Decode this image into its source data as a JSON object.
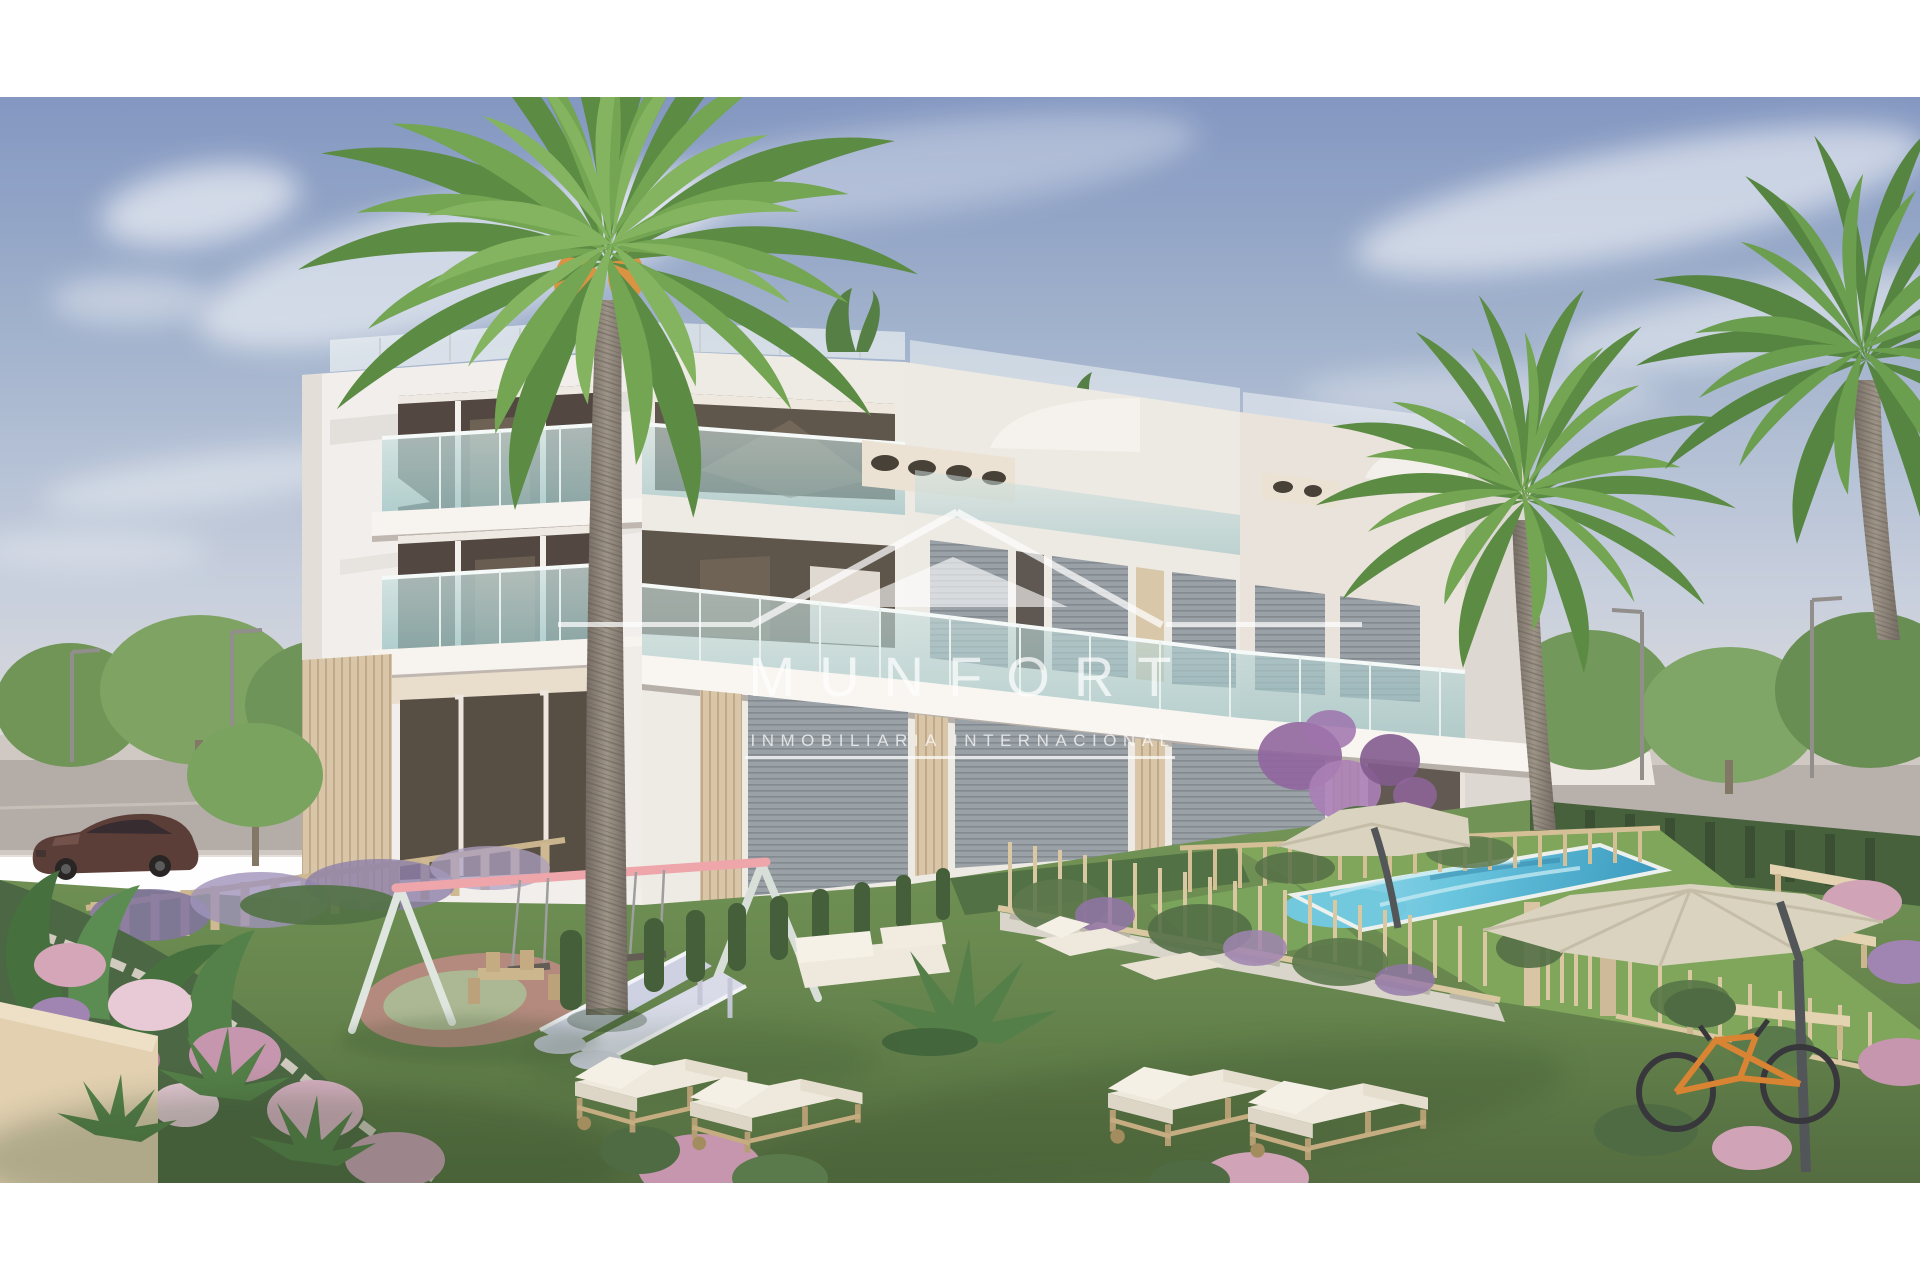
{
  "watermark": {
    "brand": "MUNFORT",
    "tagline": "INMOBILIARIA INTERNACIONAL",
    "color": "#ffffff",
    "opacity": "0.72"
  },
  "scene": {
    "description": "3D architectural rendering of a modern white three-storey apartment residence with glass balconies, palm trees, communal garden, swimming pool, playground and sun loungers",
    "palette": {
      "sky_top": "#7e93bf",
      "sky_horizon": "#e6e0dd",
      "building_white": "#f2efeb",
      "building_shade": "#ded7d1",
      "wood_slat": "#d8c5a5",
      "glass_teal": "#9ec9c9",
      "window_dark": "#4a4038",
      "shutter_gray": "#949ba2",
      "lawn": "#5f7f45",
      "turf_light": "#7ba355",
      "pool_water": "#62c3dd",
      "pool_deep": "#2f93bb",
      "umbrella_cream": "#d9d2bd",
      "fence_tan": "#d3bd92",
      "flower_pink": "#d3a3b6",
      "flower_purple": "#9c7fae",
      "palm_green": "#5b8f3f",
      "palm_trunk": "#8d8276",
      "road_gray": "#b2aaa4",
      "car_maroon": "#553530",
      "swing_pink": "#efa3a8",
      "slide_lavender": "#ccd0e2",
      "playpad_mauve": "#b08578",
      "playpad_green": "#a9b68f",
      "bike_orange": "#d97f2a"
    }
  }
}
